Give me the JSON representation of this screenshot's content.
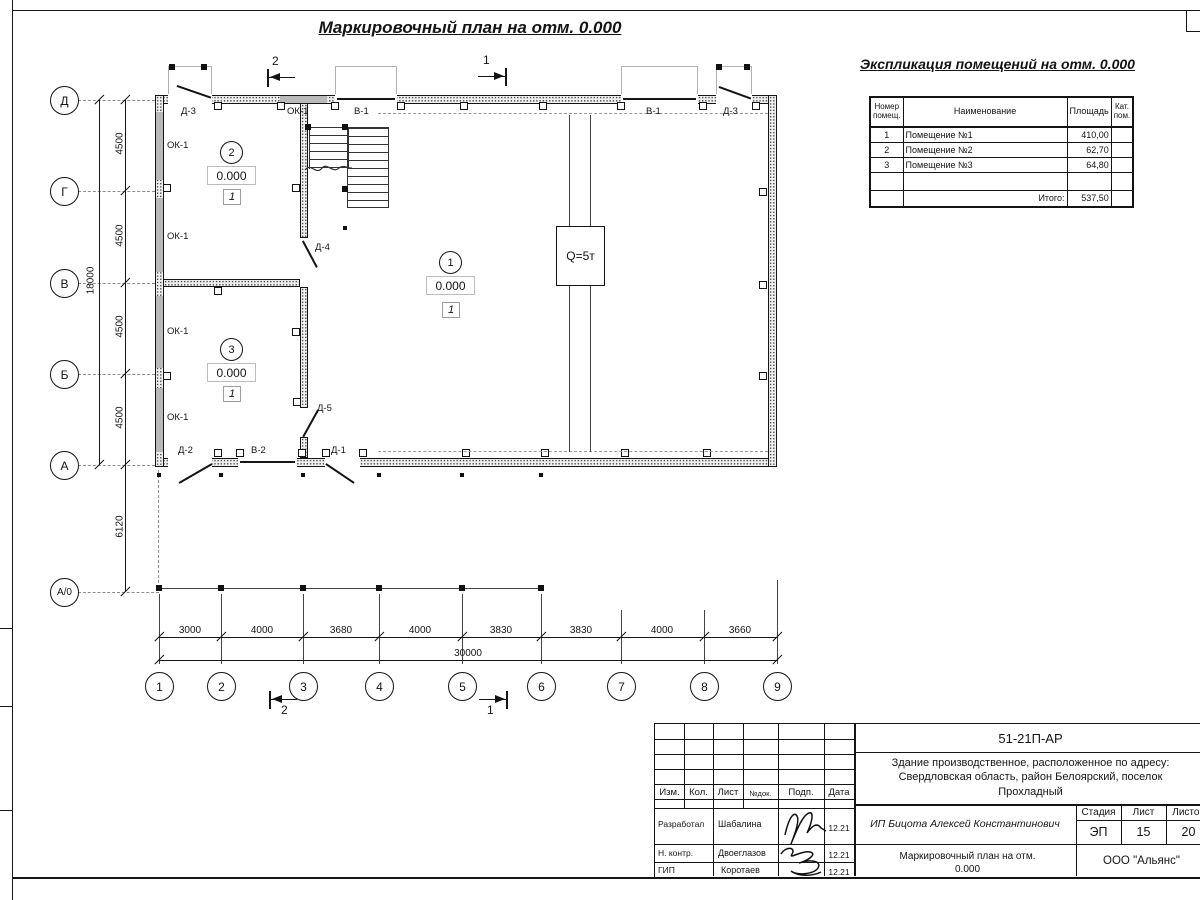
{
  "titles": {
    "plan": "Маркировочный план на отм. 0.000",
    "schedule": "Экспликация помещений на отм. 0.000"
  },
  "axes": {
    "rows": [
      "Д",
      "Г",
      "В",
      "Б",
      "А",
      "А/0"
    ],
    "cols": [
      "1",
      "2",
      "3",
      "4",
      "5",
      "6",
      "7",
      "8",
      "9"
    ],
    "row_dims": [
      "4500",
      "4500",
      "4500",
      "4500"
    ],
    "row_total": "18000",
    "a0_dim": "6120",
    "col_dims": [
      "3000",
      "4000",
      "3680",
      "4000",
      "3830",
      "3830",
      "4000",
      "3660"
    ],
    "col_total": "30000"
  },
  "sections": {
    "s1": "1",
    "s2": "2"
  },
  "crane": {
    "label": "Q=5т"
  },
  "rooms": [
    {
      "num": "1",
      "elev": "0.000",
      "floor": "1"
    },
    {
      "num": "2",
      "elev": "0.000",
      "floor": "1"
    },
    {
      "num": "3",
      "elev": "0.000",
      "floor": "1"
    }
  ],
  "marks": {
    "ok1": "ОК-1",
    "v1": "В-1",
    "v2": "В-2",
    "d1": "Д-1",
    "d2": "Д-2",
    "d3": "Д-3",
    "d4": "Д-4",
    "d5": "Д-5"
  },
  "schedule": {
    "col_num": "Номер помещ.",
    "col_name": "Наименование",
    "col_area": "Площадь",
    "col_cat": "Кат. пом.",
    "rows": [
      {
        "num": "1",
        "name": "Помещение №1",
        "area": "410,00",
        "cat": ""
      },
      {
        "num": "2",
        "name": "Помещение №2",
        "area": "62,70",
        "cat": ""
      },
      {
        "num": "3",
        "name": "Помещение №3",
        "area": "64,80",
        "cat": ""
      }
    ],
    "total_label": "Итого:",
    "total_value": "537,50"
  },
  "stamp": {
    "doc": "51-21П-АР",
    "addr1": "Здание производственное, расположенное по адресу:",
    "addr2": "Свердловская область, район Белоярский, поселок",
    "addr3": "Прохладный",
    "client": "ИП Бицота Алексей Константинович",
    "h_izm": "Изм.",
    "h_kol": "Кол.",
    "h_list": "Лист",
    "h_ndok": "№док.",
    "h_podp": "Подп.",
    "h_data": "Дата",
    "r1_role": "Разработал",
    "r1_name": "Шабалина",
    "r1_date": "12.21",
    "r2_role": "Н. контр.",
    "r2_name": "Двоеглазов",
    "r2_date": "12.21",
    "r3_role": "ГИП",
    "r3_name": "Коротаев",
    "r3_date": "12.21",
    "stage_h": "Стадия",
    "list_h": "Лист",
    "listov_h": "Листов",
    "stage": "ЭП",
    "list": "15",
    "listov": "20",
    "title1": "Маркировочный план на отм.",
    "title2": "0.000",
    "firm": "ООО \"Альянс\""
  }
}
